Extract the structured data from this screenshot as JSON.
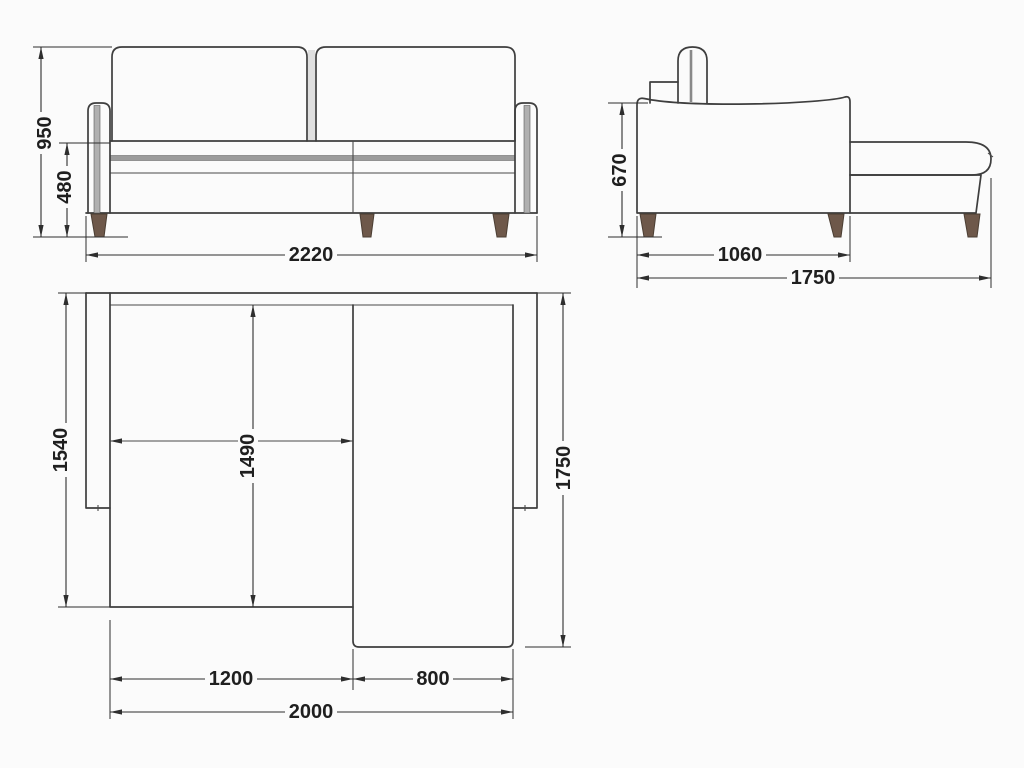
{
  "title": "corner-sofa-dimension-drawing",
  "colors": {
    "background": "#fbfbfb",
    "line": "#3e3e3e",
    "leg_wood": "#6e584a",
    "rail_gray": "#9c9c9c"
  },
  "views": {
    "front": {
      "dims": {
        "total_height": "950",
        "seat_height": "480",
        "total_width": "2220"
      }
    },
    "side": {
      "dims": {
        "arm_height": "670",
        "body_depth": "1060",
        "total_depth": "1750"
      }
    },
    "top": {
      "dims": {
        "left_depth": "1540",
        "inner_depth": "1490",
        "total_depth": "1750",
        "seat_section_width": "1200",
        "chaise_width": "800",
        "total_width": "2000"
      }
    }
  }
}
